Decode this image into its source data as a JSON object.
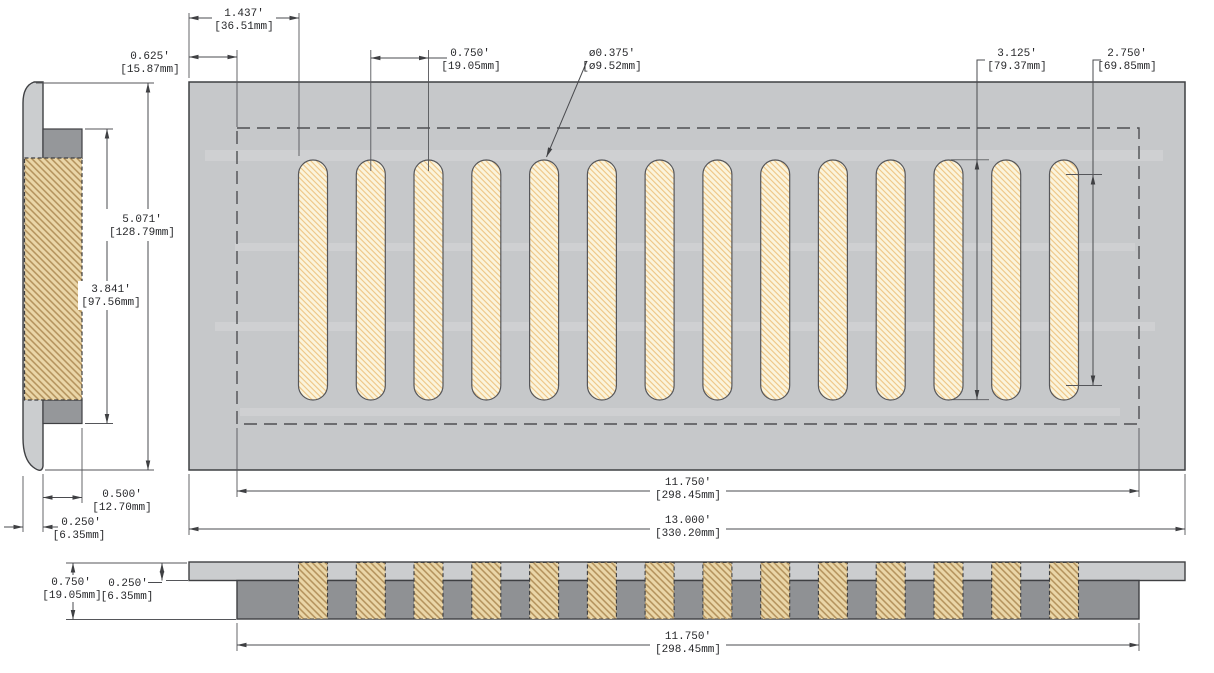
{
  "drawing": {
    "slot_count": 14
  },
  "colors": {
    "plate_gray": "#c6c8ca",
    "frame_dark_gray": "#95979a",
    "faceplate_light_gray": "#cbcdcf",
    "slot_fill": "#fbf4dc",
    "slot_hatch": "#eec584",
    "wood_fill": "#ead6a8",
    "wood_hatch": "#b2905a",
    "outline": "#3f4043",
    "dimension_line": "#4a4b4f",
    "text": "#26272a"
  },
  "dims": {
    "edge_to_first_slot": {
      "in": "1.437'",
      "mm": "[36.51mm]"
    },
    "border_offset": {
      "in": "0.625'",
      "mm": "[15.87mm]"
    },
    "slot_pitch": {
      "in": "0.750'",
      "mm": "[19.05mm]"
    },
    "slot_width": {
      "in": "ø0.375'",
      "mm": "[ø9.52mm]"
    },
    "slot_length": {
      "in": "3.125'",
      "mm": "[79.37mm]"
    },
    "slot_inner_length": {
      "in": "2.750'",
      "mm": "[69.85mm]"
    },
    "overall_height": {
      "in": "5.071'",
      "mm": "[128.79mm]"
    },
    "opening_height": {
      "in": "3.841'",
      "mm": "[97.56mm]"
    },
    "insert_depth": {
      "in": "0.500'",
      "mm": "[12.70mm]"
    },
    "face_thickness": {
      "in": "0.250'",
      "mm": "[6.35mm]"
    },
    "opening_width": {
      "in": "11.750'",
      "mm": "[298.45mm]"
    },
    "overall_width": {
      "in": "13.000'",
      "mm": "[330.20mm]"
    },
    "profile_height": {
      "in": "0.750'",
      "mm": "[19.05mm]"
    },
    "profile_face_thickness": {
      "in": "0.250'",
      "mm": "[6.35mm]"
    },
    "profile_opening_width": {
      "in": "11.750'",
      "mm": "[298.45mm]"
    }
  }
}
